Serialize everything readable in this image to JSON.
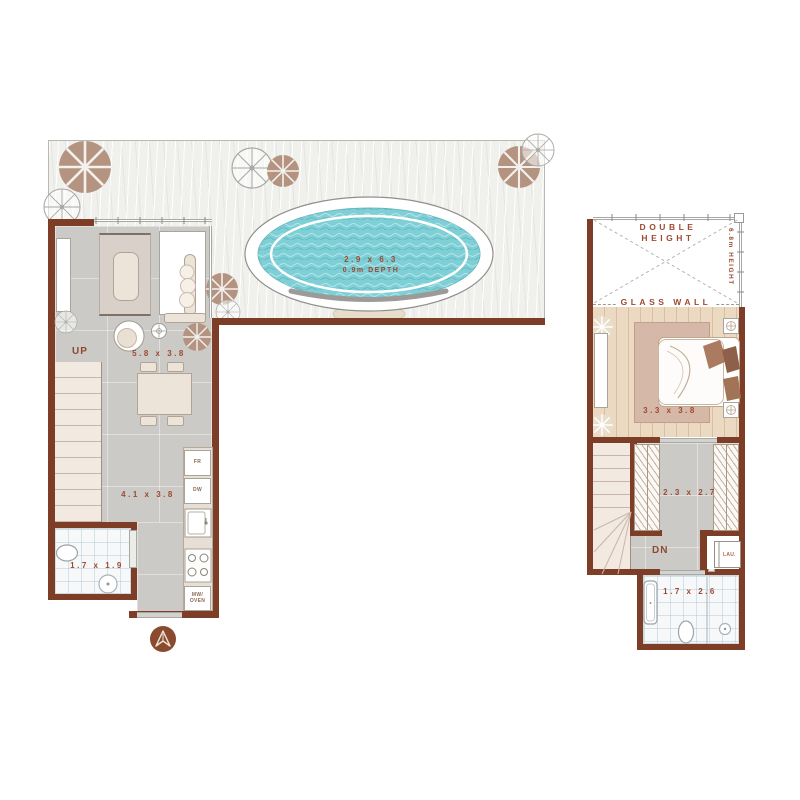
{
  "title": "two-level villa floor plan with pool",
  "colors": {
    "wall": "#7e3d26",
    "label": "#9d4a31",
    "pool_water": "#7ecfd6",
    "wood_floor": "#ead6bf",
    "gray_floor": "#cbcac6"
  },
  "first_floor": {
    "stairs_label": "UP",
    "living_dining_dim": "5.8 x 3.8",
    "kitchen_dim": "4.1 x 3.8",
    "bathroom_dim": "1.7 x 1.9",
    "appliances": {
      "fridge": "FR",
      "dishwasher": "DW",
      "microwave_oven": "MW/\nOVEN"
    }
  },
  "terrace": {
    "pool_dim": "2.9 x 6.3",
    "pool_depth": "0.9m DEPTH"
  },
  "second_floor": {
    "void_label": "DOUBLE\nHEIGHT",
    "height_label": "6.8m HEIGHT",
    "glass_wall_label": "GLASS WALL",
    "bedroom_dim": "3.3 x 3.8",
    "wardrobe_dim": "2.3 x 2.7",
    "stairs_label": "DN",
    "laundry_label": "LAU.",
    "bathroom_dim": "1.7 x 2.6"
  }
}
